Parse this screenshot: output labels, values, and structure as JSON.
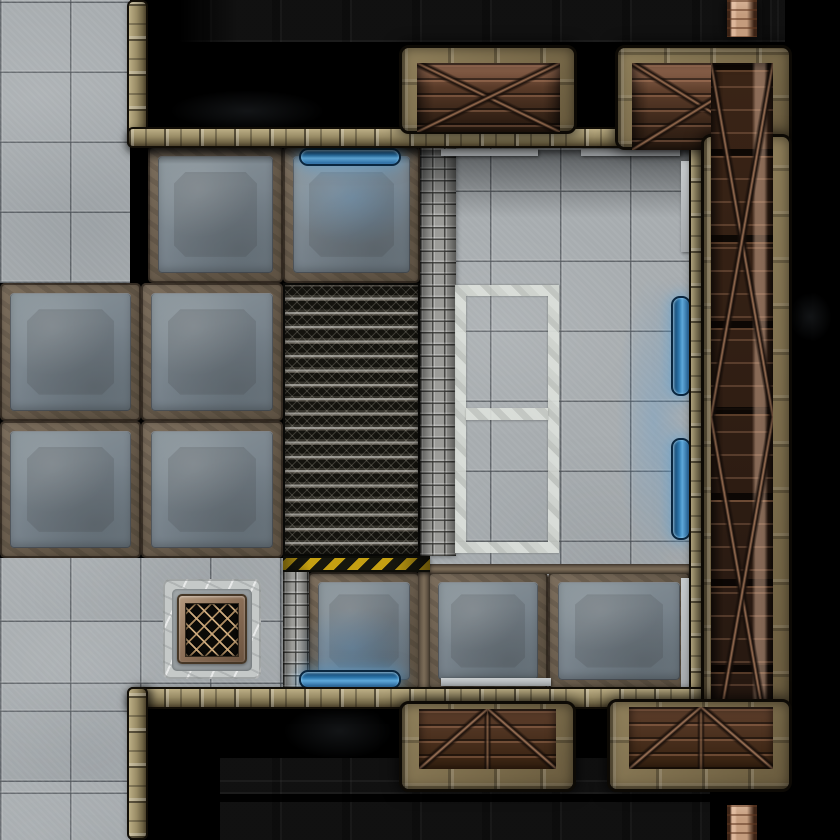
{
  "meta": {
    "description": "top-down sci-fi station battle map tile scene",
    "grid": {
      "cols": 12,
      "rows": 12,
      "tile_px": 70
    },
    "canvas": {
      "w": 840,
      "h": 840
    }
  },
  "palette": {
    "void_black": "#000000",
    "floor_gray": "#a7acaf",
    "panel_gray": "#76818a",
    "panel_frame_rust": "#6e6153",
    "wall_tan": "#998c66",
    "walkway_frame": "#7a6a4b",
    "plank_dark_brown": "#241710",
    "plank_light": "#c49c7d",
    "mesh_black": "#0e0e0b",
    "cobble_gray": "#91918d",
    "hazard_yellow": "#c5a012",
    "hazard_black": "#17170e",
    "glow_blue": "#5fa9da",
    "door_blue_dark": "#0e3a5e",
    "marking_white": "#dde1dc",
    "grate_gold": "#cba97d"
  },
  "scene": {
    "elements": [
      {
        "name": "void-floor-tiles-north",
        "type": "darktiles",
        "x": 148,
        "y": 0,
        "w": 637,
        "h": 42,
        "inter": false
      },
      {
        "name": "void-fade-northwest",
        "type": "voidfade",
        "x": 148,
        "y": 0,
        "w": 90,
        "h": 44,
        "inter": false
      },
      {
        "name": "void-floor-tiles-south",
        "type": "darktiles",
        "x": 220,
        "y": 758,
        "w": 490,
        "h": 82,
        "inter": false
      },
      {
        "name": "fog-smudge",
        "type": "smudge",
        "x": 140,
        "y": 82,
        "w": 215,
        "h": 58,
        "inter": false
      },
      {
        "name": "fog-smudge",
        "type": "smudge",
        "x": 612,
        "y": 82,
        "w": 120,
        "h": 60,
        "inter": false
      },
      {
        "name": "fog-smudge",
        "type": "smudge",
        "x": 262,
        "y": 692,
        "w": 155,
        "h": 78,
        "inter": false
      },
      {
        "name": "fog-smudge",
        "type": "smudge",
        "x": 780,
        "y": 282,
        "w": 60,
        "h": 70,
        "inter": false
      },
      {
        "name": "floor-tiles-northwest",
        "type": "tiles",
        "x": 0,
        "y": 0,
        "w": 130,
        "h": 283,
        "inter": true
      },
      {
        "name": "floor-tiles-southwest",
        "type": "tiles",
        "x": 0,
        "y": 558,
        "w": 285,
        "h": 132,
        "inter": true
      },
      {
        "name": "floor-tiles-west-edge",
        "type": "tiles",
        "x": 0,
        "y": 688,
        "w": 130,
        "h": 152,
        "inter": true
      },
      {
        "name": "room-floor-tiles",
        "type": "tiles",
        "x": 420,
        "y": 148,
        "w": 272,
        "h": 542,
        "inter": true
      },
      {
        "name": "floor-panel",
        "type": "panel",
        "x": 0,
        "y": 283,
        "w": 141,
        "h": 138,
        "inter": true
      },
      {
        "name": "floor-panel",
        "type": "panel",
        "x": 141,
        "y": 283,
        "w": 142,
        "h": 138,
        "inter": true
      },
      {
        "name": "floor-panel",
        "type": "panel",
        "x": 0,
        "y": 421,
        "w": 141,
        "h": 137,
        "inter": true
      },
      {
        "name": "floor-panel",
        "type": "panel",
        "x": 141,
        "y": 421,
        "w": 142,
        "h": 137,
        "inter": true
      },
      {
        "name": "floor-panel",
        "type": "panel",
        "x": 148,
        "y": 146,
        "w": 135,
        "h": 137,
        "inter": true
      },
      {
        "name": "floor-panel",
        "type": "panel",
        "x": 283,
        "y": 146,
        "w": 137,
        "h": 137,
        "inter": true
      },
      {
        "name": "floor-panel",
        "type": "panel",
        "x": 308,
        "y": 572,
        "w": 112,
        "h": 118,
        "inter": true
      },
      {
        "name": "floor-panel",
        "type": "panel",
        "x": 428,
        "y": 572,
        "w": 120,
        "h": 118,
        "inter": true
      },
      {
        "name": "floor-panel",
        "type": "panel",
        "x": 548,
        "y": 572,
        "w": 142,
        "h": 118,
        "inter": true
      },
      {
        "name": "panel-frame-strip",
        "type": "ruststrip-h",
        "x": 428,
        "y": 564,
        "w": 262,
        "h": 10,
        "inter": false
      },
      {
        "name": "panel-frame-strip",
        "type": "ruststrip-v",
        "x": 418,
        "y": 572,
        "w": 12,
        "h": 118,
        "inter": false
      },
      {
        "name": "mesh-catwalk",
        "type": "mesh",
        "x": 283,
        "y": 283,
        "w": 137,
        "h": 273,
        "inter": true
      },
      {
        "name": "hazard-stripe",
        "type": "hazard",
        "x": 283,
        "y": 556,
        "w": 147,
        "h": 16,
        "inter": false
      },
      {
        "name": "cobblestone-path",
        "type": "cobble",
        "x": 420,
        "y": 146,
        "w": 36,
        "h": 410,
        "inter": true
      },
      {
        "name": "cobblestone-path",
        "type": "cobble",
        "x": 283,
        "y": 572,
        "w": 26,
        "h": 116,
        "inter": true
      },
      {
        "name": "wall-shadow",
        "type": "shade",
        "x": 420,
        "y": 150,
        "w": 272,
        "h": 68,
        "inter": false
      },
      {
        "name": "wall-shadow",
        "type": "shade",
        "x": 148,
        "y": 148,
        "w": 270,
        "h": 16,
        "inter": false
      },
      {
        "name": "floor-marking-zone",
        "type": "wrect",
        "x": 455,
        "y": 285,
        "w": 104,
        "h": 268,
        "inter": true
      },
      {
        "name": "floor-marking-divider",
        "type": "wrectbar",
        "x": 466,
        "y": 408,
        "w": 82,
        "h": 12,
        "inter": false
      },
      {
        "name": "floor-grate-base",
        "type": "grate-out",
        "x": 163,
        "y": 579,
        "w": 98,
        "h": 100,
        "inter": false
      },
      {
        "name": "floor-grate-band",
        "type": "grate-band",
        "x": 172,
        "y": 589,
        "w": 80,
        "h": 82,
        "inter": false
      },
      {
        "name": "floor-grate-frame",
        "type": "grate-frame",
        "x": 177,
        "y": 594,
        "w": 70,
        "h": 70,
        "inter": false
      },
      {
        "name": "floor-grate",
        "type": "grate-mesh",
        "x": 185,
        "y": 603,
        "w": 54,
        "h": 54,
        "inter": true
      },
      {
        "name": "door-bar",
        "type": "doorbar",
        "x": 441,
        "y": 149,
        "w": 97,
        "h": 7,
        "inter": true
      },
      {
        "name": "door-bar",
        "type": "doorbar",
        "x": 581,
        "y": 149,
        "w": 99,
        "h": 7,
        "inter": true
      },
      {
        "name": "door-bar",
        "type": "doorbar",
        "x": 681,
        "y": 161,
        "w": 8,
        "h": 91,
        "inter": true
      },
      {
        "name": "door-bar",
        "type": "doorbar",
        "x": 681,
        "y": 578,
        "w": 8,
        "h": 110,
        "inter": true
      },
      {
        "name": "door-bar",
        "type": "doorbar",
        "x": 441,
        "y": 678,
        "w": 110,
        "h": 8,
        "inter": true
      },
      {
        "name": "door-glow",
        "type": "bluetint",
        "x": 288,
        "y": 150,
        "w": 128,
        "h": 95,
        "inter": false
      },
      {
        "name": "door-glow",
        "type": "bluetint",
        "x": 293,
        "y": 608,
        "w": 118,
        "h": 80,
        "inter": false
      },
      {
        "name": "door-glow",
        "type": "bluetint",
        "x": 616,
        "y": 276,
        "w": 76,
        "h": 292,
        "inter": false
      },
      {
        "name": "energy-door",
        "type": "bluedoor-h",
        "x": 299,
        "y": 148,
        "w": 102,
        "h": 18,
        "inter": true
      },
      {
        "name": "energy-door",
        "type": "bluedoor-h",
        "x": 299,
        "y": 670,
        "w": 102,
        "h": 19,
        "inter": true
      },
      {
        "name": "energy-door",
        "type": "bluedoor-v",
        "x": 671,
        "y": 296,
        "w": 20,
        "h": 100,
        "inter": true
      },
      {
        "name": "energy-door",
        "type": "bluedoor-v",
        "x": 671,
        "y": 438,
        "w": 20,
        "h": 102,
        "inter": true
      },
      {
        "name": "wall",
        "type": "wall-v",
        "x": 127,
        "y": 0,
        "w": 21,
        "h": 148,
        "inter": false
      },
      {
        "name": "wall",
        "type": "wall-h",
        "x": 127,
        "y": 127,
        "w": 583,
        "h": 21,
        "inter": false
      },
      {
        "name": "wall",
        "type": "wall-v",
        "x": 689,
        "y": 127,
        "w": 21,
        "h": 583,
        "inter": false
      },
      {
        "name": "wall",
        "type": "wall-h",
        "x": 127,
        "y": 687,
        "w": 583,
        "h": 22,
        "inter": false
      },
      {
        "name": "wall",
        "type": "wall-v",
        "x": 127,
        "y": 687,
        "w": 21,
        "h": 153,
        "inter": false
      },
      {
        "name": "cargo-bridge-north",
        "type": "wkf",
        "x": 399,
        "y": 45,
        "w": 178,
        "h": 89,
        "inter": true
      },
      {
        "name": "bridge-planks",
        "type": "planks-tw",
        "x": 417,
        "y": 63,
        "w": 143,
        "h": 69,
        "inter": true
      },
      {
        "name": "cargo-walkway-east",
        "type": "wkf",
        "x": 615,
        "y": 45,
        "w": 177,
        "h": 105,
        "inter": true
      },
      {
        "name": "walkway-planks",
        "type": "planks-tw",
        "x": 632,
        "y": 63,
        "w": 141,
        "h": 87,
        "inter": true
      },
      {
        "name": "cargo-walkway-east",
        "type": "wkf",
        "x": 701,
        "y": 134,
        "w": 91,
        "h": 638,
        "inter": true
      },
      {
        "name": "walkway-planks",
        "type": "planks-rw",
        "x": 711,
        "y": 63,
        "w": 62,
        "h": 709,
        "inter": true
      },
      {
        "name": "cargo-walkway-east",
        "type": "wkf",
        "x": 607,
        "y": 699,
        "w": 185,
        "h": 93,
        "inter": true
      },
      {
        "name": "walkway-planks",
        "type": "planks-bw",
        "x": 629,
        "y": 707,
        "w": 144,
        "h": 62,
        "inter": true
      },
      {
        "name": "cargo-bridge-south",
        "type": "wkf",
        "x": 399,
        "y": 701,
        "w": 177,
        "h": 91,
        "inter": true
      },
      {
        "name": "bridge-planks",
        "type": "planks-bw",
        "x": 419,
        "y": 709,
        "w": 137,
        "h": 60,
        "inter": true
      },
      {
        "name": "plank-strip-north",
        "type": "planks-strip",
        "x": 727,
        "y": 0,
        "w": 30,
        "h": 37,
        "inter": true
      },
      {
        "name": "plank-strip-south",
        "type": "planks-strip",
        "x": 727,
        "y": 805,
        "w": 30,
        "h": 35,
        "inter": true
      }
    ]
  }
}
